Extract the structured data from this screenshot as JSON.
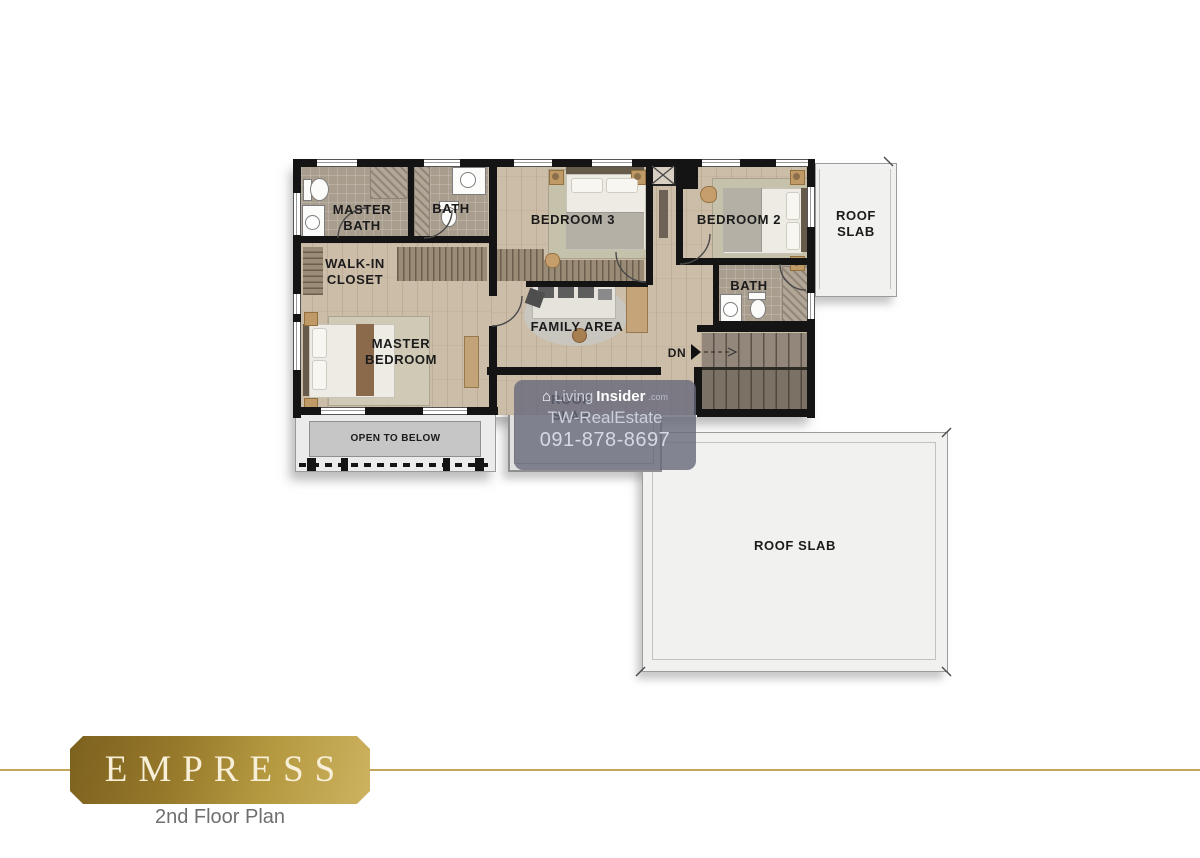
{
  "plan": {
    "rooms": {
      "master_bath": "MASTER\nBATH",
      "bath_top": "BATH",
      "bedroom3": "BEDROOM 3",
      "bedroom2": "BEDROOM 2",
      "walk_in_closet": "WALK-IN\nCLOSET",
      "family_area": "FAMILY AREA",
      "master_bedroom": "MASTER\nBEDROOM",
      "bath_right": "BATH",
      "open_to_below": "OPEN TO BELOW"
    },
    "stairs": {
      "dn_label": "DN"
    },
    "roof_slabs": {
      "top_right": "ROOF\nSLAB",
      "center": "ROOF\nSLAB",
      "large": "ROOF SLAB"
    }
  },
  "watermark": {
    "brand_living": "Living",
    "brand_insider": "Insider",
    "brand_tld": ".com",
    "line2": "TW-RealEstate",
    "line3": "091-878-8697"
  },
  "title_block": {
    "name": "EMPRESS",
    "subtitle": "2nd Floor Plan"
  },
  "colors": {
    "wall": "#141414",
    "wood_floor": "#ccbda8",
    "bath_tile": "#a99d8e",
    "roof_slab": "#f1f1ef",
    "open_to_below_gray": "#c6c6c6",
    "stairs_upper": "#93867a",
    "stairs_lower": "#7c7165",
    "watermark_bg": "rgba(103,105,122,0.8)",
    "plaque_gold_dark": "#7c611e",
    "plaque_gold_light": "#cdb261",
    "plaque_text": "#f7efd7",
    "gold_line": "#c4a75c",
    "subtitle_text": "#6f6f6f"
  }
}
